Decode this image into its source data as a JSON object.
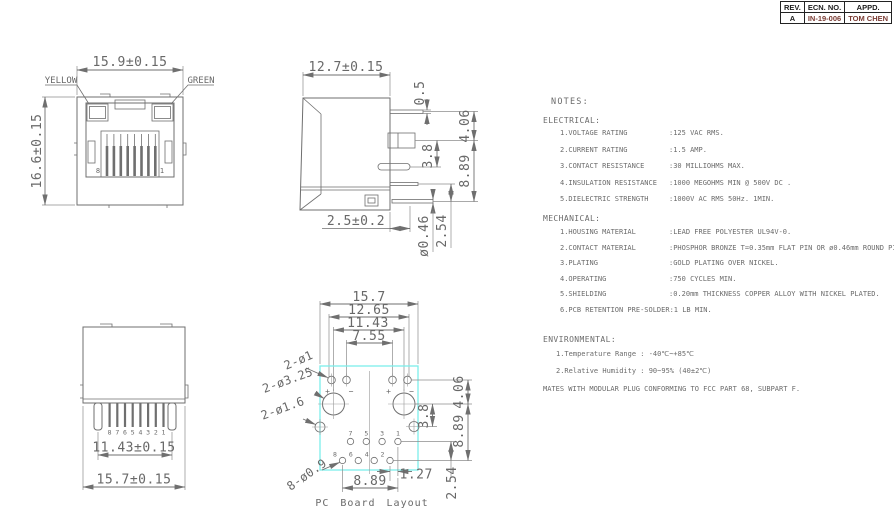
{
  "colors": {
    "line_gray": "#6f6f6f",
    "text_gray": "#686868",
    "pcb_outline_cyan": "#7deeea",
    "rev_value_maroon": "#7a3c34",
    "table_black": "#1c1c1c"
  },
  "rev_table": {
    "headers": [
      "REV.",
      "ECN. NO.",
      "APPD."
    ],
    "row": {
      "rev": "A",
      "ecn_no": "IN-19-006",
      "appd": "TOM CHEN"
    }
  },
  "front_view": {
    "width_dim": "15.9±0.15",
    "height_dim": "16.6±0.15",
    "led_left": "YELLOW",
    "led_right": "GREEN",
    "pin_left": "8",
    "pin_right": "1"
  },
  "side_view": {
    "width_dim": "12.7±0.15",
    "pin_thickness": "0.5",
    "dim_a": "4.06",
    "dim_b": "3.8",
    "dim_c": "8.89",
    "standoff": "2.5±0.2",
    "pin_dia": "ø0.46",
    "pitch": "2.54"
  },
  "bottom_view": {
    "pin_numbers": [
      "8",
      "7",
      "6",
      "5",
      "4",
      "3",
      "2",
      "1"
    ],
    "span_dim": "11.43±0.15",
    "width_dim": "15.7±0.15"
  },
  "pcb_layout": {
    "caption": "PC Board Layout",
    "dim_width": "15.7",
    "dim_led_outer": "12.65",
    "dim_mount": "11.43",
    "dim_led_inner": "7.55",
    "leader_led": "2-ø1",
    "leader_mount": "2-ø3.25",
    "leader_lock": "2-ø1.6",
    "leader_pins": "8-ø0.9",
    "dim_right_a": "4.06",
    "dim_right_b": "3.8",
    "dim_right_c": "8.89",
    "dim_row_offset": "1.27",
    "dim_row_span": "8.89",
    "dim_pitch": "2.54",
    "pins_top": [
      "7",
      "5",
      "3",
      "1"
    ],
    "pins_bottom": [
      "8",
      "6",
      "4",
      "2"
    ],
    "polarity": {
      "plus": "+",
      "minus": "−"
    }
  },
  "notes": {
    "title": "NOTES:",
    "electrical": {
      "heading": "ELECTRICAL:",
      "items": [
        {
          "label": "1.VOLTAGE RATING",
          "value": ":125 VAC RMS."
        },
        {
          "label": "2.CURRENT RATING",
          "value": ":1.5 AMP."
        },
        {
          "label": "3.CONTACT RESISTANCE",
          "value": ":30 MILLIOHMS MAX."
        },
        {
          "label": "4.INSULATION RESISTANCE",
          "value": ":1000 MEGOHMS MIN @ 500V DC ."
        },
        {
          "label": "5.DIELECTRIC STRENGTH",
          "value": ":1000V AC RMS 50Hz. 1MIN."
        }
      ]
    },
    "mechanical": {
      "heading": "MECHANICAL:",
      "items": [
        {
          "label": "1.HOUSING MATERIAL",
          "value": ":LEAD FREE POLYESTER UL94V-0."
        },
        {
          "label": "2.CONTACT MATERIAL",
          "value": ":PHOSPHOR BRONZE T=0.35mm FLAT PIN OR ø0.46mm ROUND PIN."
        },
        {
          "label": "3.PLATING",
          "value": ":GOLD PLATING OVER NICKEL."
        },
        {
          "label": "4.OPERATING",
          "value": ":750 CYCLES MIN."
        },
        {
          "label": "5.SHIELDING",
          "value": ":0.20mm THICKNESS COPPER ALLOY WITH NICKEL PLATED."
        },
        {
          "label": "6.PCB RETENTION PRE-SOLDER",
          "value": ":1 LB MIN."
        }
      ]
    },
    "environmental": {
      "heading": "ENVIRONMENTAL:",
      "items": [
        "1.Temperature Range : -40℃~+85℃",
        "2.Relative Humidity : 90~95% (40±2℃)"
      ]
    },
    "footer": "MATES WITH MODULAR PLUG CONFORMING TO FCC PART 68, SUBPART F."
  }
}
